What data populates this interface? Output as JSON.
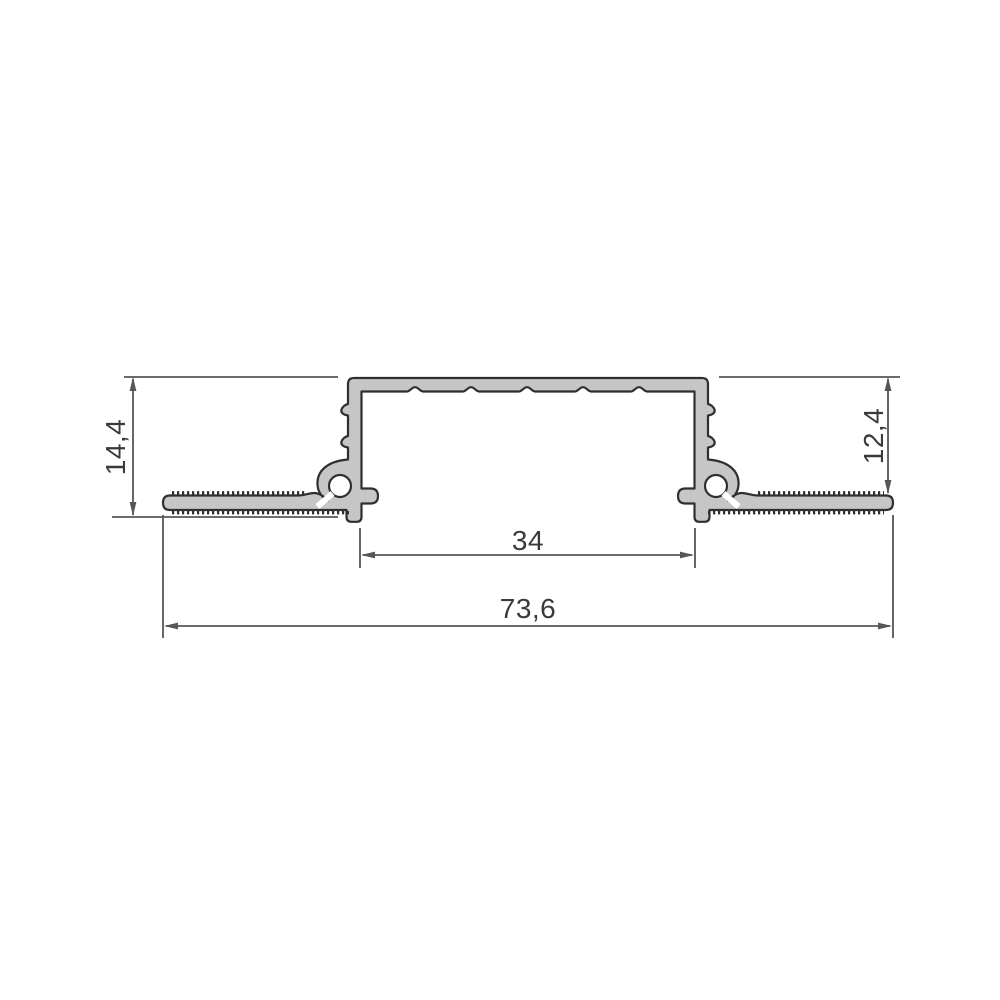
{
  "drawing": {
    "name": "aluminium-profile-cross-section",
    "profile": {
      "fill_color": "#c6c6c6",
      "outline_color": "#2f2f2f"
    },
    "dimension_style": {
      "line_color": "#55565a",
      "text_color": "#3a3a3a"
    },
    "dimensions": {
      "height_left": {
        "label": "14,4",
        "orientation": "vertical"
      },
      "height_right": {
        "label": "12,4",
        "orientation": "vertical"
      },
      "inner_width": {
        "label": "34",
        "orientation": "horizontal"
      },
      "overall_width": {
        "label": "73,6",
        "orientation": "horizontal"
      }
    }
  }
}
